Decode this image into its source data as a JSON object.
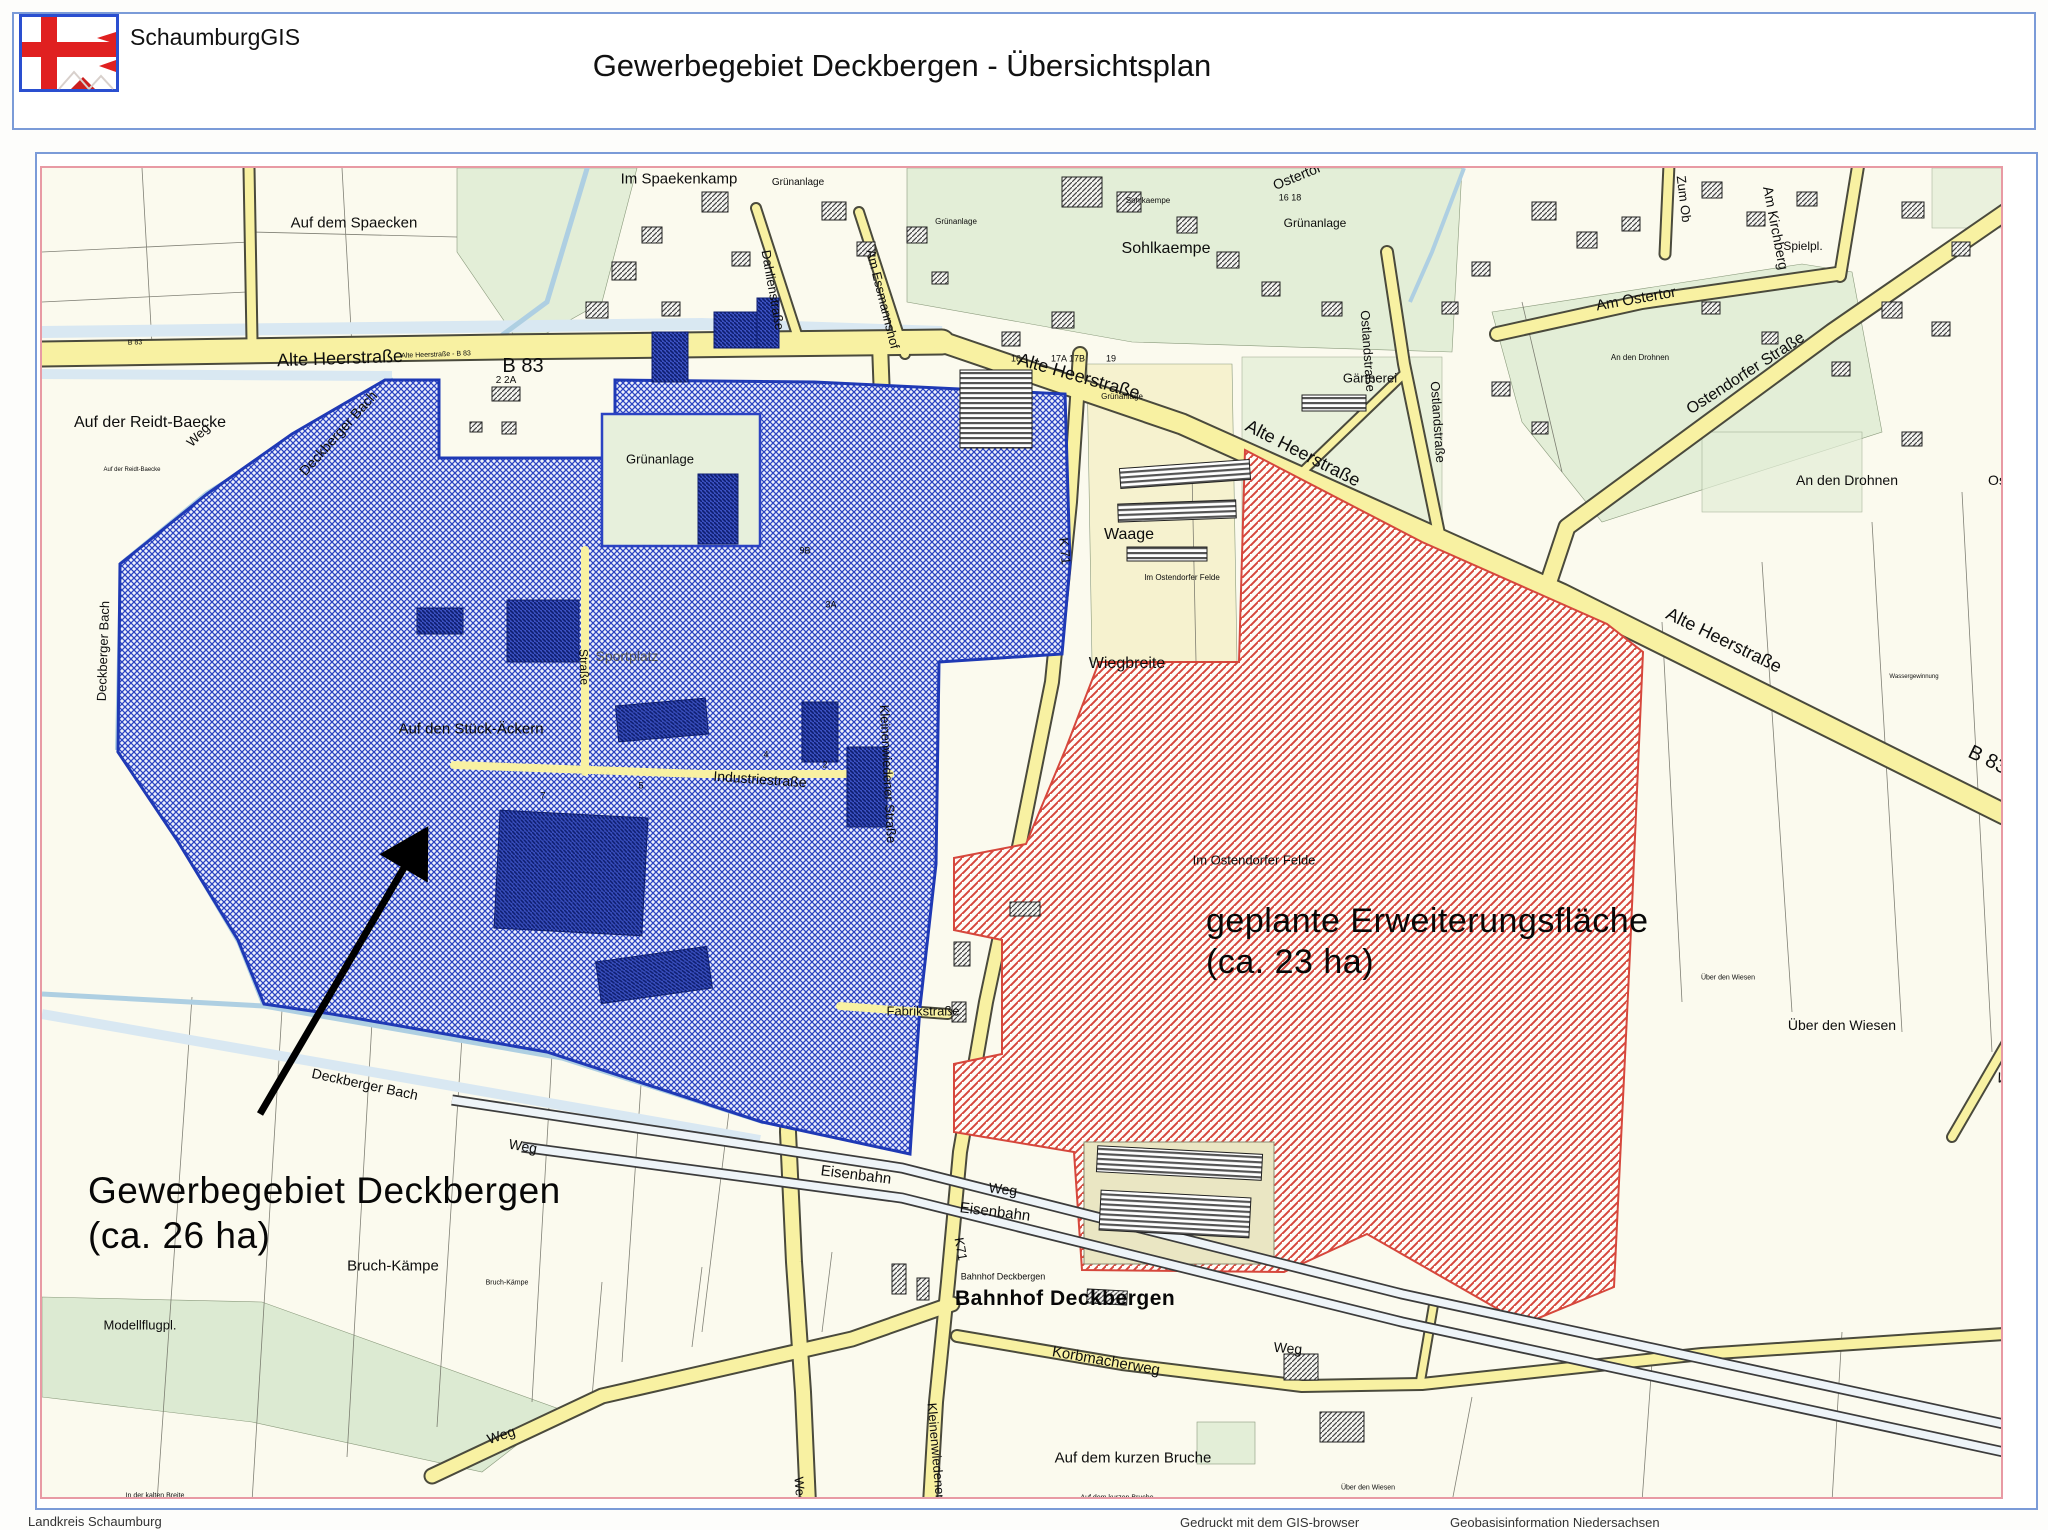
{
  "header": {
    "app_name": "SchaumburgGIS",
    "title": "Gewerbegebiet Deckbergen - Übersichtsplan"
  },
  "map": {
    "annotations": {
      "site_line1": "Gewerbegebiet Deckbergen",
      "site_line2": "(ca. 26 ha)",
      "expansion_line1": "geplante Erweiterungsfläche",
      "expansion_line2": "(ca. 23 ha)",
      "station": "Bahnhof Deckbergen"
    },
    "labels": [
      {
        "t": "Im Spaekenkamp",
        "x": 677,
        "y": 177,
        "s": 15
      },
      {
        "t": "Grünanlage",
        "x": 796,
        "y": 181,
        "s": 10
      },
      {
        "t": "Auf dem Spaecken",
        "x": 352,
        "y": 221,
        "s": 15
      },
      {
        "t": "Sohlkaempe",
        "x": 1146,
        "y": 199,
        "s": 8
      },
      {
        "t": "Sohlkaempe",
        "x": 1164,
        "y": 247,
        "s": 16
      },
      {
        "t": "Grünanlage",
        "x": 1313,
        "y": 221,
        "s": 12
      },
      {
        "t": "Grünanlage",
        "x": 954,
        "y": 220,
        "s": 8
      },
      {
        "t": "Grünanlage",
        "x": 1120,
        "y": 395,
        "s": 8
      },
      {
        "t": "Am Ostertor",
        "x": 1757,
        "y": 129,
        "s": 14
      },
      {
        "t": "Ostertor",
        "x": 1295,
        "y": 174,
        "s": 14,
        "r": -22
      },
      {
        "t": "16 18",
        "x": 1288,
        "y": 196,
        "s": 9
      },
      {
        "t": "Zum Ob",
        "x": 1682,
        "y": 197,
        "s": 13,
        "r": 83
      },
      {
        "t": "Am Kirchberg",
        "x": 1774,
        "y": 226,
        "s": 14,
        "r": 79
      },
      {
        "t": "Spielpl.",
        "x": 1801,
        "y": 244,
        "s": 12
      },
      {
        "t": "Am Ostertor",
        "x": 1634,
        "y": 297,
        "s": 15,
        "r": -10
      },
      {
        "t": "Ostendorfer Straße",
        "x": 1744,
        "y": 372,
        "s": 16,
        "r": -33
      },
      {
        "t": "An den Drohnen",
        "x": 1638,
        "y": 356,
        "s": 8
      },
      {
        "t": "An den Drohnen",
        "x": 1845,
        "y": 478,
        "s": 14
      },
      {
        "t": "Os",
        "x": 1995,
        "y": 478,
        "s": 14
      },
      {
        "t": "Dahlienstraße",
        "x": 771,
        "y": 288,
        "s": 13,
        "r": 80
      },
      {
        "t": "Am Essmannshof",
        "x": 881,
        "y": 297,
        "s": 13,
        "r": 76
      },
      {
        "t": "Gärtnerei",
        "x": 1368,
        "y": 376,
        "s": 13
      },
      {
        "t": "B 83",
        "x": 133,
        "y": 341,
        "s": 7,
        "r": -2
      },
      {
        "t": "Alte Heerstraße",
        "x": 338,
        "y": 356,
        "s": 18,
        "r": -2
      },
      {
        "t": "Alte Heerstraße - B 83",
        "x": 434,
        "y": 353,
        "s": 7,
        "r": -2
      },
      {
        "t": "B 83",
        "x": 521,
        "y": 364,
        "s": 20
      },
      {
        "t": "2 2A",
        "x": 504,
        "y": 379,
        "s": 10
      },
      {
        "t": "16",
        "x": 1014,
        "y": 357,
        "s": 9
      },
      {
        "t": "17A 17B",
        "x": 1066,
        "y": 357,
        "s": 9
      },
      {
        "t": "19",
        "x": 1109,
        "y": 357,
        "s": 9
      },
      {
        "t": "Alte Heerstraße",
        "x": 1077,
        "y": 374,
        "s": 18,
        "r": 16
      },
      {
        "t": "Alte Heerstraße",
        "x": 1301,
        "y": 451,
        "s": 18,
        "r": 27
      },
      {
        "t": "Alte Heerstraße",
        "x": 1722,
        "y": 638,
        "s": 18,
        "r": 26
      },
      {
        "t": "B 83",
        "x": 1986,
        "y": 758,
        "s": 20,
        "r": 26
      },
      {
        "t": "Ostlandstraße",
        "x": 1366,
        "y": 349,
        "s": 13,
        "r": 86
      },
      {
        "t": "Ostlandstraße",
        "x": 1436,
        "y": 420,
        "s": 13,
        "r": 86
      },
      {
        "t": "Waage",
        "x": 1127,
        "y": 533,
        "s": 16
      },
      {
        "t": "Wiegbreite",
        "x": 1125,
        "y": 662,
        "s": 16
      },
      {
        "t": "K 71",
        "x": 1063,
        "y": 549,
        "s": 13,
        "r": 84
      },
      {
        "t": "Im Ostendorfer Felde",
        "x": 1180,
        "y": 576,
        "s": 8
      },
      {
        "t": "Im Ostendorfer Felde",
        "x": 1252,
        "y": 858,
        "s": 13
      },
      {
        "t": "Straße",
        "x": 582,
        "y": 665,
        "s": 12,
        "r": 88
      },
      {
        "t": "Industriestraße",
        "x": 758,
        "y": 777,
        "s": 14,
        "r": 4
      },
      {
        "t": "Sportplatz",
        "x": 625,
        "y": 654,
        "s": 14,
        "c": "#555555"
      },
      {
        "t": "Auf den Stück-Äckern",
        "x": 469,
        "y": 727,
        "s": 15
      },
      {
        "t": "Grünanlage",
        "x": 658,
        "y": 457,
        "s": 13
      },
      {
        "t": "9B",
        "x": 803,
        "y": 549,
        "s": 9
      },
      {
        "t": "3A",
        "x": 829,
        "y": 603,
        "s": 9
      },
      {
        "t": "4",
        "x": 764,
        "y": 753,
        "s": 9
      },
      {
        "t": "2",
        "x": 823,
        "y": 763,
        "s": 9
      },
      {
        "t": "5",
        "x": 639,
        "y": 784,
        "s": 9
      },
      {
        "t": "7",
        "x": 541,
        "y": 794,
        "s": 9
      },
      {
        "t": "Auf der Reidt-Baecke",
        "x": 148,
        "y": 421,
        "s": 16
      },
      {
        "t": "Auf der Reidt-Baecke",
        "x": 130,
        "y": 468,
        "s": 6
      },
      {
        "t": "Weg",
        "x": 196,
        "y": 433,
        "s": 13,
        "r": -45
      },
      {
        "t": "Deckberger Bach",
        "x": 336,
        "y": 431,
        "s": 14,
        "r": -48
      },
      {
        "t": "Deckberger Bach",
        "x": 101,
        "y": 649,
        "s": 13,
        "r": -88
      },
      {
        "t": "Deckberger Bach",
        "x": 363,
        "y": 1082,
        "s": 14,
        "r": 12
      },
      {
        "t": "Weg",
        "x": 521,
        "y": 1144,
        "s": 14,
        "r": 10
      },
      {
        "t": "Kleinenwiedener Straße",
        "x": 886,
        "y": 772,
        "s": 13,
        "r": 87
      },
      {
        "t": "Fabrikstraße",
        "x": 921,
        "y": 1009,
        "s": 13
      },
      {
        "t": "Eisenbahn",
        "x": 854,
        "y": 1173,
        "s": 15,
        "r": 7
      },
      {
        "t": "Weg",
        "x": 1001,
        "y": 1187,
        "s": 14,
        "r": 7
      },
      {
        "t": "Eisenbahn",
        "x": 993,
        "y": 1210,
        "s": 15,
        "r": 7
      },
      {
        "t": "K71",
        "x": 959,
        "y": 1247,
        "s": 13,
        "r": 80
      },
      {
        "t": "Bahnhof Deckbergen",
        "x": 1001,
        "y": 1275,
        "s": 9
      },
      {
        "t": "Korbmacherweg",
        "x": 1104,
        "y": 1359,
        "s": 15,
        "r": 10
      },
      {
        "t": "Kleinenwiedener Straße",
        "x": 936,
        "y": 1470,
        "s": 13,
        "r": 85
      },
      {
        "t": "Auf dem kurzen Bruche",
        "x": 1131,
        "y": 1456,
        "s": 15
      },
      {
        "t": "Auf dem kurzen Bruche",
        "x": 1115,
        "y": 1496,
        "s": 7
      },
      {
        "t": "Bruch-Kämpe",
        "x": 391,
        "y": 1264,
        "s": 15
      },
      {
        "t": "Bruch-Kämpe",
        "x": 505,
        "y": 1281,
        "s": 7
      },
      {
        "t": "Modellflugpl.",
        "x": 138,
        "y": 1323,
        "s": 13
      },
      {
        "t": "In der kalten Breite",
        "x": 153,
        "y": 1494,
        "s": 7
      },
      {
        "t": "Weg",
        "x": 499,
        "y": 1433,
        "s": 14,
        "r": -18
      },
      {
        "t": "Weg",
        "x": 798,
        "y": 1488,
        "s": 13,
        "r": 85
      },
      {
        "t": "Weg",
        "x": 1286,
        "y": 1346,
        "s": 14,
        "r": 5
      },
      {
        "t": "Weg",
        "x": 2009,
        "y": 1079,
        "s": 14,
        "r": 18
      },
      {
        "t": "Über den Wiesen",
        "x": 1726,
        "y": 976,
        "s": 7
      },
      {
        "t": "Über den Wiesen",
        "x": 1840,
        "y": 1023,
        "s": 14
      },
      {
        "t": "Über den Wiesen",
        "x": 1366,
        "y": 1486,
        "s": 7
      },
      {
        "t": "Wassergewinnung",
        "x": 1912,
        "y": 675,
        "s": 6
      }
    ]
  },
  "footer": {
    "left": "Landkreis Schaumburg",
    "right_1": "Gedruckt mit dem GIS-browser",
    "right_2": "Geobasisinformation Niedersachsen"
  },
  "colors": {
    "frame_blue": "#7b9bd8",
    "border_pink": "#e89aa4",
    "road_yellow": "#f8f1a2",
    "water_blue": "#aecfe2",
    "green_area": "#e3eed7",
    "green_dark": "#a9cb8c",
    "site_blue": "#1f39b5",
    "site_hatch": "#2b43c2",
    "expansion_red": "#d6473c"
  }
}
